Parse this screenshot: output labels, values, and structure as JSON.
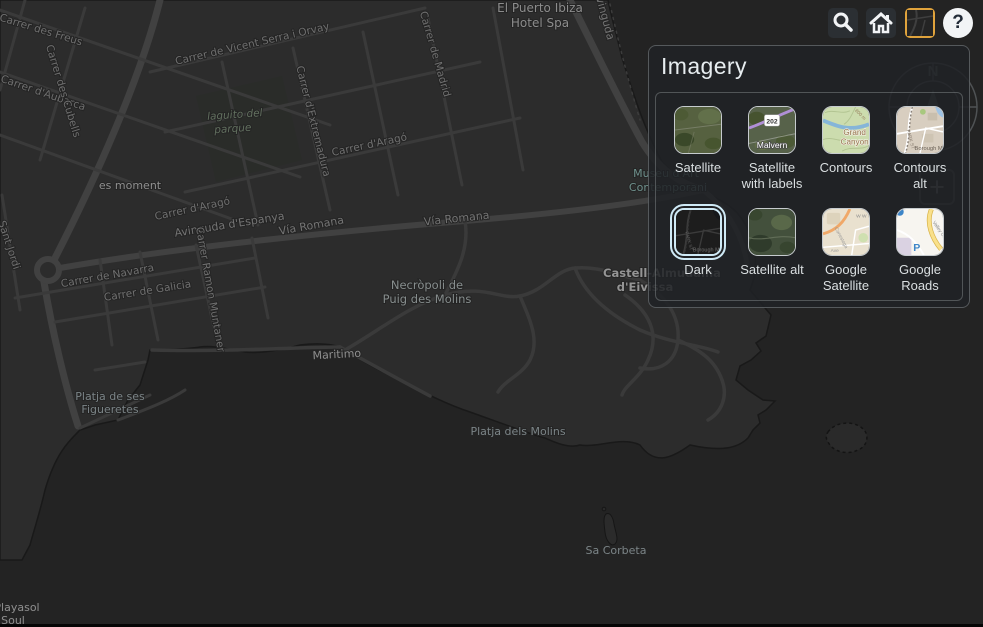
{
  "toolbar": {
    "search": "search",
    "home": "home",
    "imagery_toggle": "imagery basemap (active)",
    "help_glyph": "?"
  },
  "imagery_panel": {
    "title": "Imagery",
    "options": [
      {
        "label": "Satellite",
        "line1": "Satellite",
        "line2": "",
        "selected": false
      },
      {
        "label": "Satellite with labels",
        "line1": "Satellite",
        "line2": "with labels",
        "selected": false,
        "thumb": {
          "shield": "202",
          "town": "Malvern"
        }
      },
      {
        "label": "Contours",
        "line1": "Contours",
        "line2": "",
        "selected": false,
        "thumb": {
          "line1": "Grand",
          "line2": "Canyon",
          "contour": "800 m"
        }
      },
      {
        "label": "Contours alt",
        "line1": "Contours",
        "line2": "alt",
        "selected": false,
        "thumb": {
          "street": "PARK ST",
          "town": "Borough M"
        }
      },
      {
        "label": "Dark",
        "line1": "Dark",
        "line2": "",
        "selected": true,
        "thumb": {
          "street": "PARK ST",
          "town": "Borough M"
        }
      },
      {
        "label": "Satellite alt",
        "line1": "Satellite alt",
        "line2": "",
        "selected": false
      },
      {
        "label": "Google Satellite",
        "line1": "Google",
        "line2": "Satellite",
        "selected": false,
        "thumb": {
          "t1": "W W",
          "t2": "Conestoga",
          "t3": "Ave"
        }
      },
      {
        "label": "Google Roads",
        "line1": "Google",
        "line2": "Roads",
        "selected": false,
        "thumb": {
          "road": "Valley Creek Blvd",
          "parking": "P"
        }
      }
    ]
  },
  "map": {
    "compass_north": "N",
    "zoom_plus": "+",
    "labels": [
      "El Puerto Ibiza",
      "Hotel Spa",
      "Avinguda",
      "Carrer des Freus",
      "Carrer d'Aubarca",
      "Carrer des Cubells",
      "Carrer de Vicent Serra i Orvay",
      "Carrer de Madrid",
      "Carrer d'Extremadura",
      "laguito del",
      "parque",
      "es moment",
      "Carrer d'Aragó",
      "Carrer d'Aragó",
      "Avinguda d'Espanya",
      "Vía Romana",
      "Vía Romana",
      "Carrer de Navarra",
      "Carrer de Galicia",
      "Carrer Ramon Muntaner",
      "Sant Jordi",
      "Necròpoli de",
      "Puig des Molins",
      "Castell-Almudaina",
      "d'Eivissa",
      "Maritimo",
      "Platja de ses",
      "Figueretes",
      "Platja dels Molins",
      "Sa Corbeta",
      "Playasol",
      "Soul",
      "Museu d'Art",
      "Contemporani"
    ]
  },
  "colors": {
    "selected_thumb_border": "#cfeaf6",
    "active_tool_border": "#e0a33c",
    "panel_bg": "rgba(32,34,37,0.86)",
    "land": "#2c2c2c",
    "sea": "#232323",
    "road": "#3e3e3e"
  }
}
